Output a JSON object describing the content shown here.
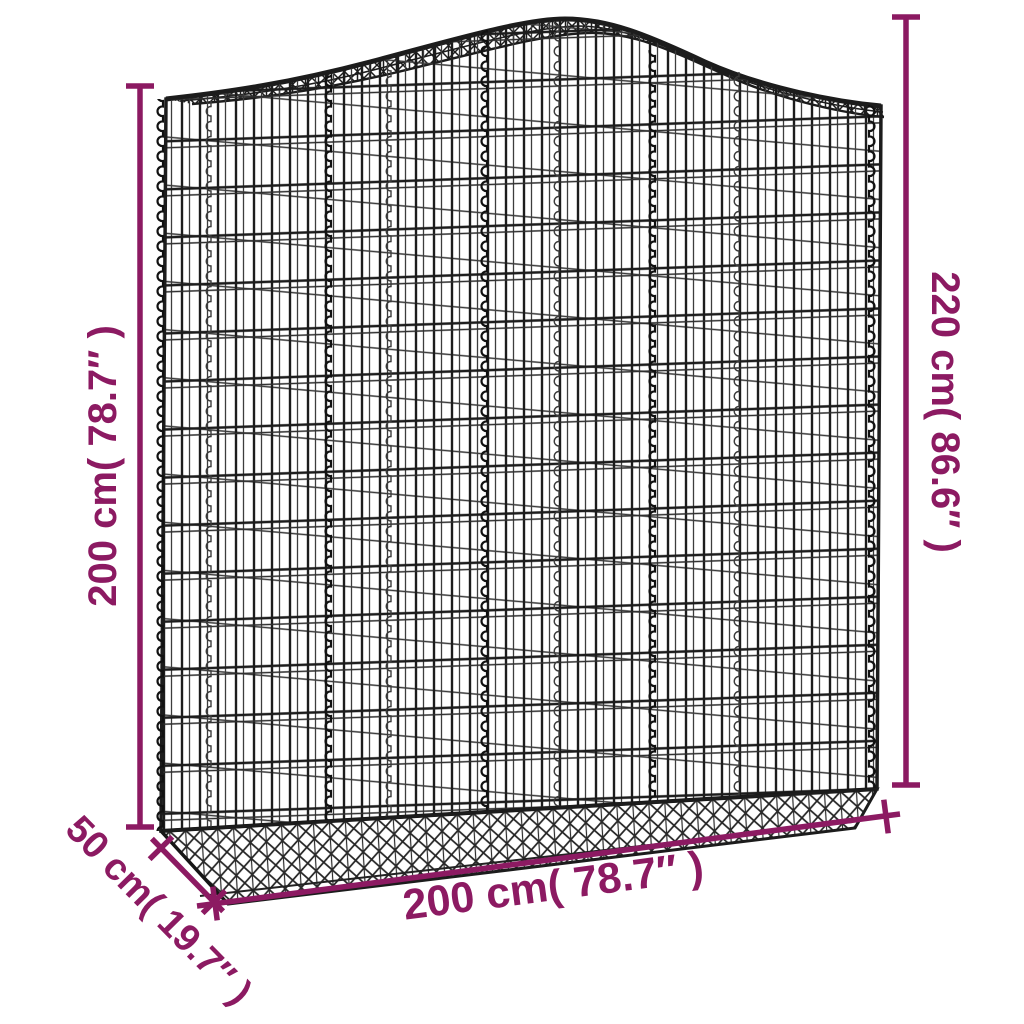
{
  "diagram": {
    "type": "product-dimension-diagram",
    "illustration": "arched-gabion-wire-mesh-basket",
    "background_color": "#ffffff",
    "colors": {
      "dimension_annotation": "#8c1a62",
      "wire_mesh": "#1c1c1c"
    },
    "dimensions": {
      "height_left": "200 cm( 78.7″ )",
      "height_right": "220 cm( 86.6″ )",
      "width_bottom": "200 cm( 78.7″ )",
      "depth": "50 cm( 19.7″ )"
    }
  }
}
